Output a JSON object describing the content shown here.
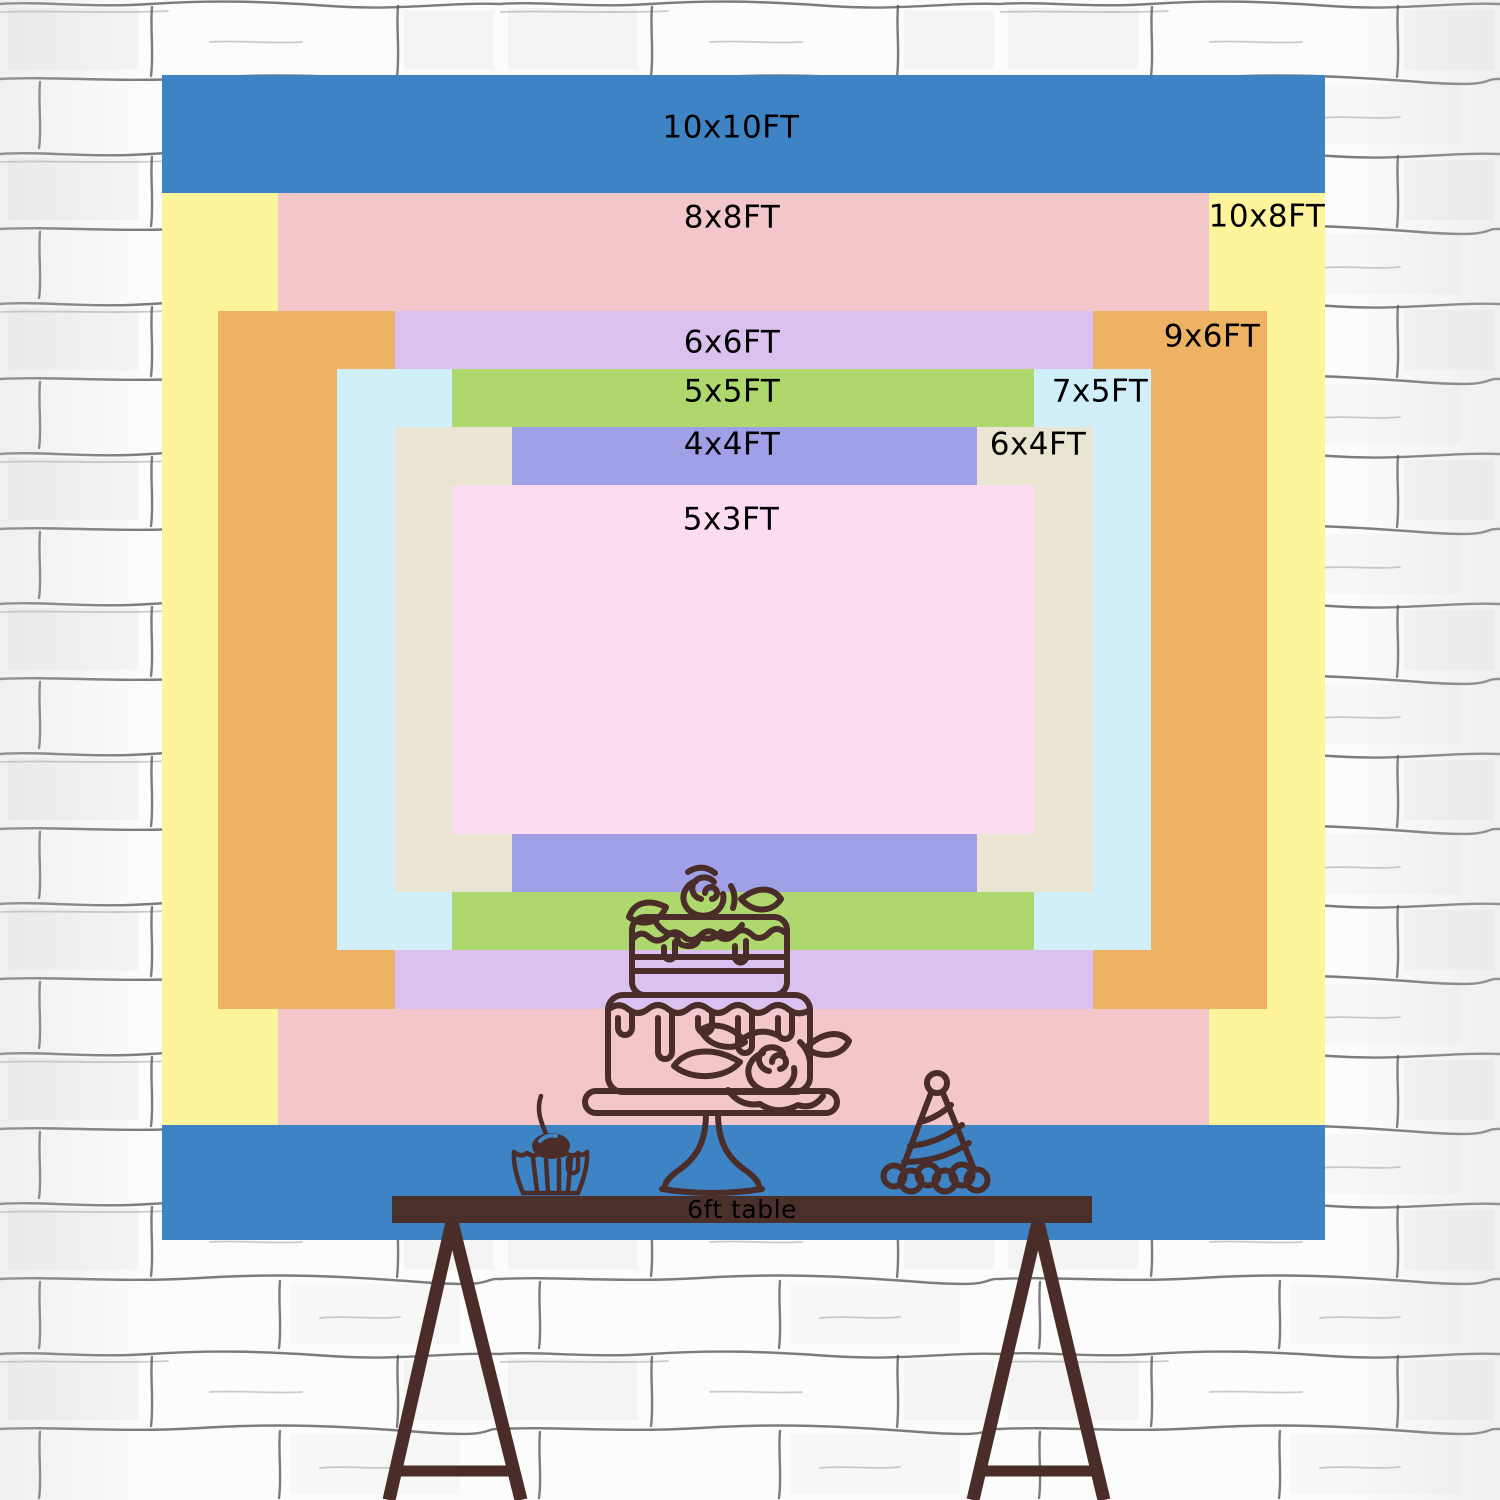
{
  "wall": {
    "background": "#fcfcfc",
    "line_color": "#4b4b4b"
  },
  "sizes": [
    {
      "id": "10x10ft",
      "label": "10x10FT",
      "width_ft": 10,
      "height_ft": 10,
      "color": "#3e84c4"
    },
    {
      "id": "10x8ft",
      "label": "10x8FT",
      "width_ft": 10,
      "height_ft": 8,
      "color": "#fdf49c"
    },
    {
      "id": "8x8ft",
      "label": "8x8FT",
      "width_ft": 8,
      "height_ft": 8,
      "color": "#f3c7c9"
    },
    {
      "id": "9x6ft",
      "label": "9x6FT",
      "width_ft": 9,
      "height_ft": 6,
      "color": "#eeb264"
    },
    {
      "id": "6x6ft",
      "label": "6x6FT",
      "width_ft": 6,
      "height_ft": 6,
      "color": "#dac1ef"
    },
    {
      "id": "7x5ft",
      "label": "7x5FT",
      "width_ft": 7,
      "height_ft": 5,
      "color": "#d0eff8"
    },
    {
      "id": "5x5ft",
      "label": "5x5FT",
      "width_ft": 5,
      "height_ft": 5,
      "color": "#aed86e"
    },
    {
      "id": "6x4ft",
      "label": "6x4FT",
      "width_ft": 6,
      "height_ft": 4,
      "color": "#eae5d3"
    },
    {
      "id": "4x4ft",
      "label": "4x4FT",
      "width_ft": 4,
      "height_ft": 4,
      "color": "#9fa0e6"
    },
    {
      "id": "5x3ft",
      "label": "5x3FT",
      "width_ft": 5,
      "height_ft": 3,
      "color": "#fcdcf0"
    }
  ],
  "label_text_color": "#000000",
  "table": {
    "label": "6ft table",
    "color": "#4a2f2b",
    "label_color": "#000000"
  },
  "illustrations": {
    "ink_color": "#4a2c28",
    "items": [
      "cake-on-stand",
      "cupcake-with-cherry",
      "party-hat"
    ]
  }
}
